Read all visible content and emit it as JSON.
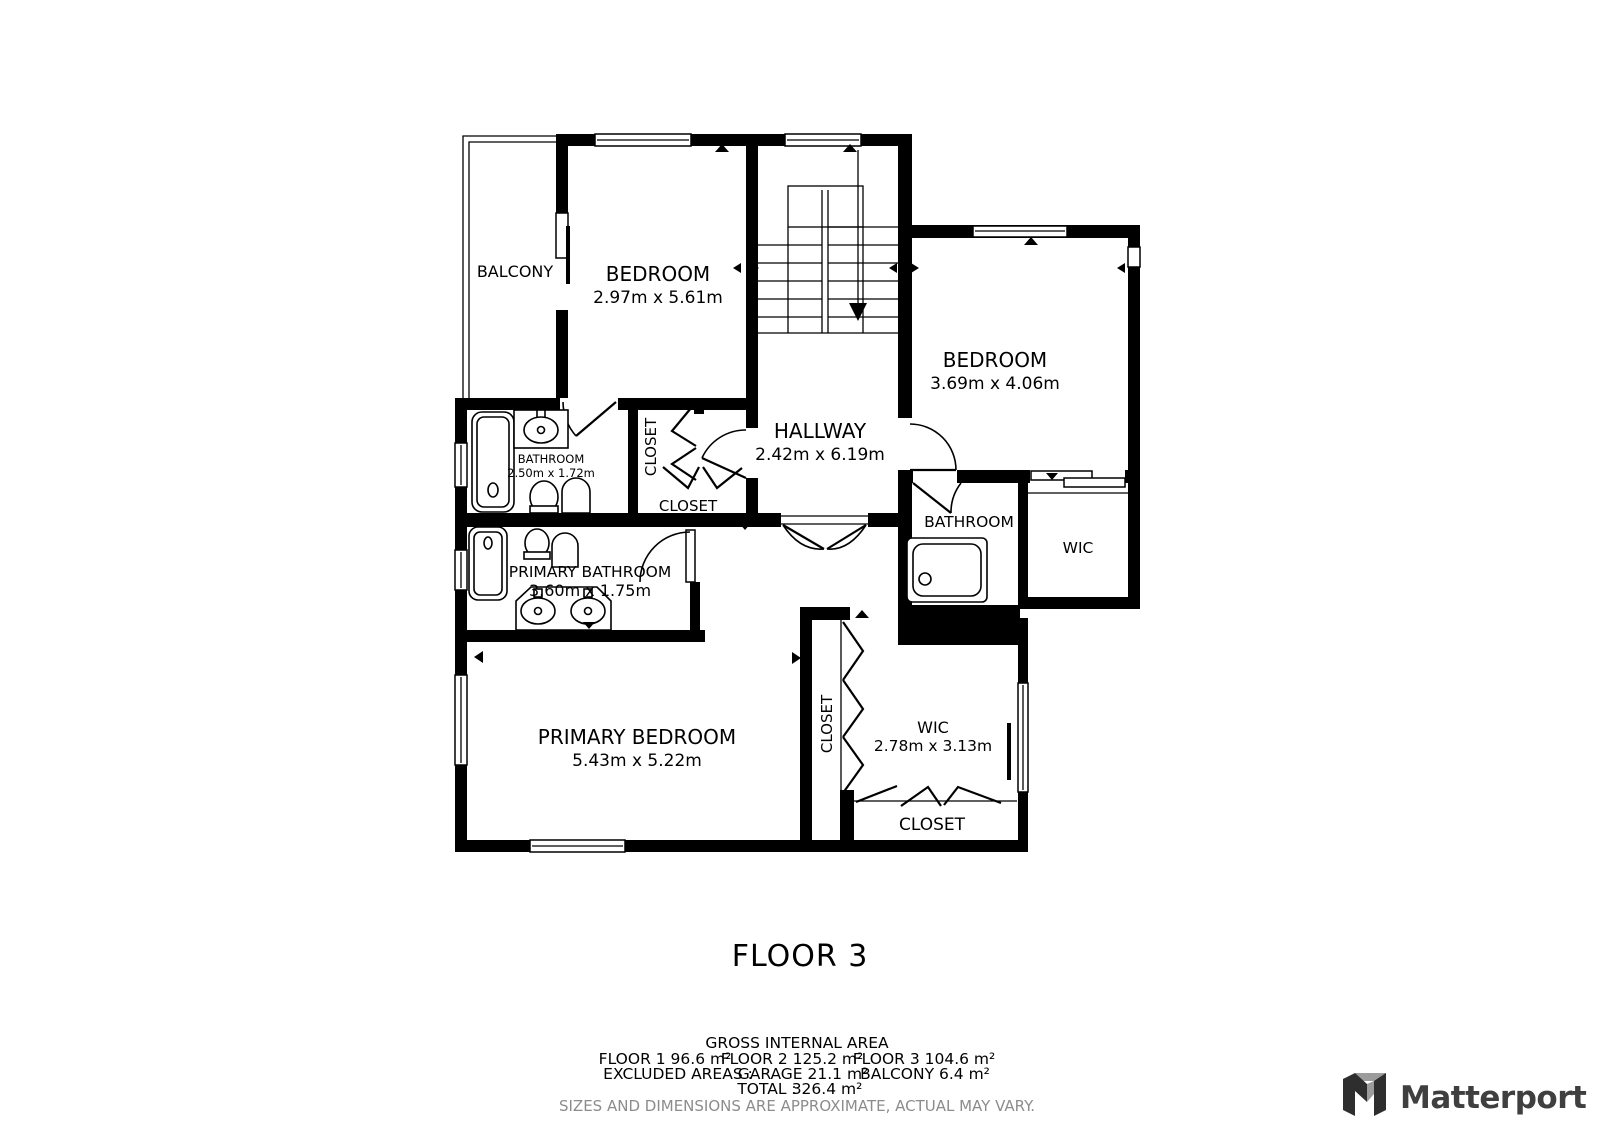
{
  "plan": {
    "title": "FLOOR 3",
    "rooms": [
      {
        "id": "balcony",
        "label": "BALCONY",
        "dims": ""
      },
      {
        "id": "bedroom-top",
        "label": "BEDROOM",
        "dims": "2.97m x 5.61m"
      },
      {
        "id": "bedroom-right",
        "label": "BEDROOM",
        "dims": "3.69m x 4.06m"
      },
      {
        "id": "hallway",
        "label": "HALLWAY",
        "dims": "2.42m x 6.19m"
      },
      {
        "id": "bathroom-top",
        "label": "BATHROOM",
        "dims": "2.50m x 1.72m"
      },
      {
        "id": "closet-hall-tall",
        "label": "CLOSET",
        "dims": ""
      },
      {
        "id": "closet-hall",
        "label": "CLOSET",
        "dims": ""
      },
      {
        "id": "primary-bathroom",
        "label": "PRIMARY BATHROOM",
        "dims": "3.60m x 1.75m"
      },
      {
        "id": "bathroom-right",
        "label": "BATHROOM",
        "dims": ""
      },
      {
        "id": "wic-right",
        "label": "WIC",
        "dims": ""
      },
      {
        "id": "primary-bedroom",
        "label": "PRIMARY BEDROOM",
        "dims": "5.43m x 5.22m"
      },
      {
        "id": "closet-strip",
        "label": "CLOSET",
        "dims": ""
      },
      {
        "id": "wic-bottom",
        "label": "WIC",
        "dims": "2.78m x 3.13m"
      },
      {
        "id": "closet-bottom",
        "label": "CLOSET",
        "dims": ""
      }
    ],
    "footer": {
      "gross_title": "GROSS INTERNAL AREA",
      "floors": [
        "FLOOR 1 96.6 m²",
        "FLOOR 2 125.2 m²",
        "FLOOR 3 104.6 m²"
      ],
      "excluded_label": "EXCLUDED AREAS :",
      "excluded": [
        "GARAGE 21.1 m²",
        "BALCONY 6.4 m²"
      ],
      "total_label": "TOTAL :",
      "total_value": "326.4 m²",
      "disclaimer": "SIZES AND DIMENSIONS ARE APPROXIMATE, ACTUAL MAY VARY."
    },
    "brand": {
      "name": "Matterport"
    },
    "colors": {
      "wall": "#000000",
      "background": "#ffffff",
      "disclaimer_text": "#8c8c8c",
      "brand_text": "#3f3f3f",
      "brand_accent_gray": "#9c9c9c"
    }
  }
}
